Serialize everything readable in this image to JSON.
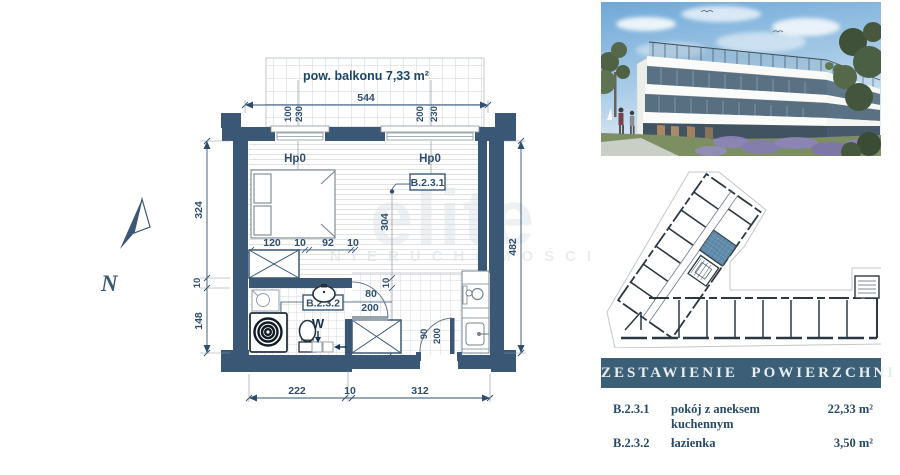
{
  "watermark": {
    "line1": "elite",
    "line2": "NIERUCHOMOŚCI"
  },
  "plan": {
    "balcony_area_label": "pow. balkonu 7,33 m²",
    "labels": {
      "hp_left": "Hp0",
      "hp_right": "Hp0",
      "unit_room": "B.2.3.1",
      "unit_bath": "B.2.3.2",
      "w1": "W",
      "w2": "W",
      "north": "N"
    },
    "dims": {
      "total_width": "544",
      "win_left_1": "100",
      "win_left_2": "230",
      "win_right_1": "200",
      "win_right_2": "230",
      "bed_1": "120",
      "bed_2": "10",
      "bed_3": "92",
      "bed_4": "10",
      "room_depth": "304",
      "left_1": "324",
      "left_2": "10",
      "left_3": "148",
      "right_total": "482",
      "bottom_1": "222",
      "bottom_2": "10",
      "bottom_3": "312",
      "hall_1": "10",
      "hall_2": "168",
      "bath_door_w": "80",
      "bath_door_h": "200",
      "entry_door_w": "90",
      "entry_door_h": "200"
    }
  },
  "table": {
    "title": "ZESTAWIENIE  POWIERZCHNI",
    "rows": [
      {
        "code": "B.2.3.1",
        "name": "pokój z aneksem kuchennym",
        "area": "22,33 m²"
      },
      {
        "code": "B.2.3.2",
        "name": "łazienka",
        "area": "3,50 m²"
      }
    ]
  },
  "colors": {
    "wall": "#3a5876",
    "dimension": "#2f4e6e",
    "highlight_unit": "#5d87a6",
    "header_bar": "#3c5f78"
  }
}
